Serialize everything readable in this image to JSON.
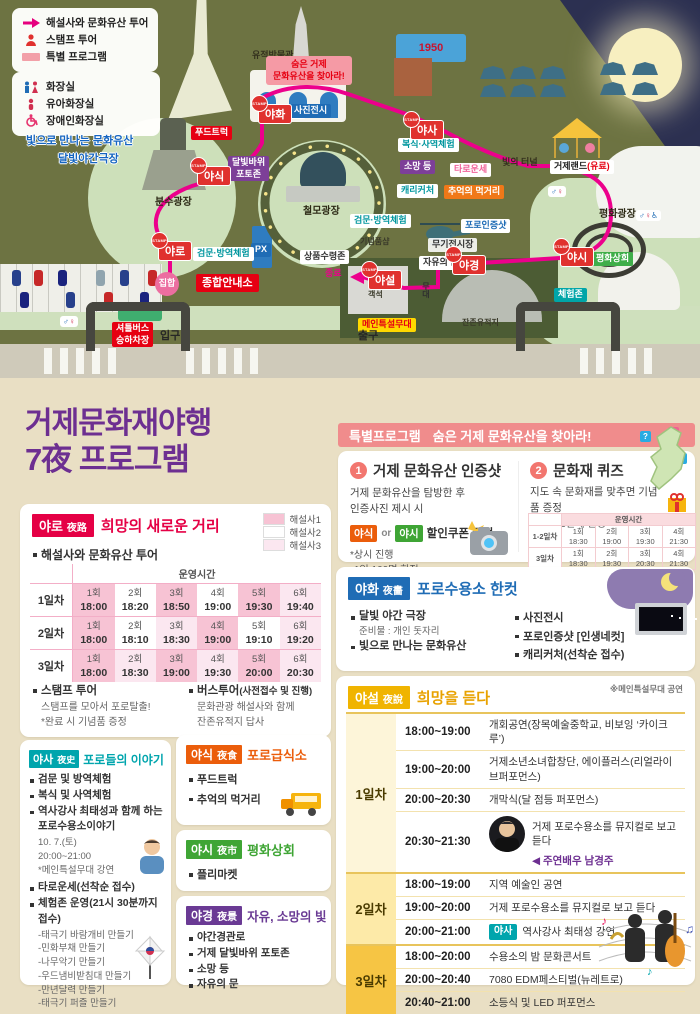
{
  "map": {
    "stamp_word": "STAMP",
    "banner": "숨은 거제\n문화유산을 찾아라!",
    "b1950": "1950",
    "legend_tour": [
      {
        "icon": "arrow-icon",
        "label": "해설사와 문화유산 투어"
      },
      {
        "icon": "person-icon",
        "label": "스탬프 투어"
      },
      {
        "icon": "bar-icon",
        "label": "특별 프로그램"
      }
    ],
    "legend_facility": [
      {
        "icon": "toilet-icon",
        "label": "화장실"
      },
      {
        "icon": "baby-icon",
        "label": "유아화장실"
      },
      {
        "icon": "wheelchair-icon",
        "label": "장애인화장실"
      }
    ],
    "labels": [
      {
        "t": "유적박물관",
        "x": 252,
        "y": 50,
        "v": "plain"
      },
      {
        "t": "숨은 거제\n문화유산을 찾아라!",
        "x": 266,
        "y": 56,
        "v": "banner"
      },
      {
        "t": "사진전시",
        "x": 290,
        "y": 104,
        "v": "blue"
      },
      {
        "t": "빛으로 만나는 문화유산",
        "x": 26,
        "y": 134,
        "v": "outblue"
      },
      {
        "t": "달빛야간극장",
        "x": 58,
        "y": 152,
        "v": "outblue"
      },
      {
        "t": "푸드트럭",
        "x": 191,
        "y": 126,
        "v": "red"
      },
      {
        "t": "달빛바위\n포토존",
        "x": 228,
        "y": 156,
        "v": "purple"
      },
      {
        "t": "분수광장",
        "x": 155,
        "y": 196,
        "v": "plainb"
      },
      {
        "t": "철모광장",
        "x": 303,
        "y": 205,
        "v": "plainb"
      },
      {
        "t": "복식·사역체험",
        "x": 398,
        "y": 138,
        "v": "tealtext"
      },
      {
        "t": "소망 등",
        "x": 400,
        "y": 160,
        "v": "purple"
      },
      {
        "t": "타로운세",
        "x": 450,
        "y": 163,
        "v": "pinktext"
      },
      {
        "t": "캐리커처",
        "x": 397,
        "y": 184,
        "v": "tealtext"
      },
      {
        "t": "추억의 먹거리",
        "x": 444,
        "y": 185,
        "v": "orange"
      },
      {
        "t": "빛의 터널",
        "x": 502,
        "y": 157,
        "v": "plain"
      },
      {
        "t": "거제랜드",
        "t2": "(유료)",
        "x": 550,
        "y": 160,
        "v": "white2"
      },
      {
        "t": "평화광장",
        "x": 599,
        "y": 208,
        "v": "plainb"
      },
      {
        "t": "검문·방역체험",
        "x": 350,
        "y": 214,
        "v": "tealtext"
      },
      {
        "t": "기념품샵",
        "x": 360,
        "y": 237,
        "v": "tiny"
      },
      {
        "t": "무기전시장",
        "x": 428,
        "y": 238,
        "v": "whiteplain"
      },
      {
        "t": "포로인증샷",
        "x": 461,
        "y": 219,
        "v": "bluetext"
      },
      {
        "t": "자유의 문",
        "x": 419,
        "y": 256,
        "v": "whiteb"
      },
      {
        "t": "PX",
        "x": 251,
        "y": 243,
        "v": "blue"
      },
      {
        "t": "검문·방역체험",
        "x": 193,
        "y": 247,
        "v": "tealtext"
      },
      {
        "t": "상품수령존",
        "x": 300,
        "y": 250,
        "v": "whiteb"
      },
      {
        "t": "종합안내소",
        "x": 196,
        "y": 274,
        "v": "redb"
      },
      {
        "t": "집합",
        "x": 155,
        "y": 272,
        "v": "pinkcircle"
      },
      {
        "t": "종료",
        "x": 325,
        "y": 268,
        "v": "pinkplain"
      },
      {
        "t": "객석",
        "x": 368,
        "y": 290,
        "v": "tiny"
      },
      {
        "t": "무대",
        "x": 420,
        "y": 282,
        "v": "tinyv"
      },
      {
        "t": "메인특설무대",
        "x": 358,
        "y": 318,
        "v": "yellow"
      },
      {
        "t": "잔존유적지",
        "x": 462,
        "y": 318,
        "v": "tiny"
      },
      {
        "t": "평화상회",
        "x": 592,
        "y": 252,
        "v": "green"
      },
      {
        "t": "체험존",
        "x": 554,
        "y": 288,
        "v": "teal"
      },
      {
        "t": "입구",
        "x": 160,
        "y": 329,
        "v": "gate"
      },
      {
        "t": "출구",
        "x": 358,
        "y": 329,
        "v": "gate"
      },
      {
        "t": "셔틀버스\n승하차장",
        "x": 112,
        "y": 322,
        "v": "red"
      }
    ],
    "stamps": [
      {
        "t": "야화",
        "x": 258,
        "y": 104
      },
      {
        "t": "야사",
        "x": 410,
        "y": 120
      },
      {
        "t": "야식",
        "x": 197,
        "y": 166
      },
      {
        "t": "야로",
        "x": 158,
        "y": 241
      },
      {
        "t": "야경",
        "x": 452,
        "y": 255
      },
      {
        "t": "야시",
        "x": 560,
        "y": 247
      },
      {
        "t": "야설",
        "x": 368,
        "y": 270
      }
    ]
  },
  "title": {
    "line1": "거제문화재야행",
    "line2": "7夜 프로그램"
  },
  "special": {
    "header_label": "특별프로그램",
    "header_title": "숨은 거제 문화유산을 찾아라!",
    "item1": {
      "num": "1",
      "title": "거제 문화유산 인증샷",
      "desc1": "거제 문화유산을 탐방한 후",
      "desc2": "인증사진 제시 시",
      "badge1": "야식",
      "or": "or",
      "badge2": "야시",
      "coupon": "할인쿠폰 증정",
      "note1": "*상시 진행",
      "note2": "1일 100명 한정"
    },
    "item2": {
      "num": "2",
      "title": "문화재 퀴즈",
      "desc": "지도 속 문화재를 맞추면 기념품 증정",
      "note": "*회당 10문제 한정",
      "markers": [
        "?",
        "?",
        "?"
      ],
      "table": {
        "time_header": "운영시간",
        "rows": [
          {
            "day": "1-2일차",
            "cells": [
              {
                "label": "1회",
                "time": "18:30"
              },
              {
                "label": "2회",
                "time": "19:00"
              },
              {
                "label": "3회",
                "time": "19:30"
              },
              {
                "label": "4회",
                "time": "21:30"
              }
            ]
          },
          {
            "day": "3일차",
            "cells": [
              {
                "label": "1회",
                "time": "18:30"
              },
              {
                "label": "2회",
                "time": "19:30"
              },
              {
                "label": "3회",
                "time": "20:30"
              },
              {
                "label": "4회",
                "time": "21:30"
              }
            ]
          }
        ]
      }
    }
  },
  "yaro": {
    "badge": "야로",
    "hanja": "夜路",
    "title": "희망의 새로운 거리",
    "legend": [
      "해설사1",
      "해설사2",
      "해설사3"
    ],
    "bullet": "해설사와 문화유산 투어",
    "table": {
      "time_header": "운영시간",
      "rows": [
        {
          "day": "1일차",
          "cells": [
            {
              "label": "1회",
              "time": "18:00",
              "c": "p"
            },
            {
              "label": "2회",
              "time": "18:20",
              "c": "w"
            },
            {
              "label": "3회",
              "time": "18:50",
              "c": "p"
            },
            {
              "label": "4회",
              "time": "19:00",
              "c": "w"
            },
            {
              "label": "5회",
              "time": "19:30",
              "c": "p"
            },
            {
              "label": "6회",
              "time": "19:40",
              "c": "l"
            }
          ]
        },
        {
          "day": "2일차",
          "cells": [
            {
              "label": "1회",
              "time": "18:00",
              "c": "p"
            },
            {
              "label": "2회",
              "time": "18:10",
              "c": "w"
            },
            {
              "label": "3회",
              "time": "18:30",
              "c": "l"
            },
            {
              "label": "4회",
              "time": "19:00",
              "c": "p"
            },
            {
              "label": "5회",
              "time": "19:10",
              "c": "w"
            },
            {
              "label": "6회",
              "time": "19:20",
              "c": "l"
            }
          ]
        },
        {
          "day": "3일차",
          "cells": [
            {
              "label": "1회",
              "time": "18:00",
              "c": "p"
            },
            {
              "label": "2회",
              "time": "18:30",
              "c": "l"
            },
            {
              "label": "3회",
              "time": "19:00",
              "c": "p"
            },
            {
              "label": "4회",
              "time": "19:30",
              "c": "l"
            },
            {
              "label": "5회",
              "time": "20:00",
              "c": "p"
            },
            {
              "label": "6회",
              "time": "20:30",
              "c": "l"
            }
          ]
        }
      ]
    },
    "notes": {
      "stamp_title": "스탬프 투어",
      "stamp_l1": "스탬프를 모아서 포로탈출!",
      "stamp_l2": "*완료 시 기념품 증정",
      "bus_title": "버스투어",
      "bus_paren": "(사전접수 및 진행)",
      "bus_l1": "문화관광 해설사와 함께",
      "bus_l2": "잔존유적지 답사"
    }
  },
  "yahwa": {
    "badge": "야화",
    "hanja": "夜畵",
    "title": "포로수용소 한컷",
    "col1": [
      {
        "text": "달빛 야간 극장",
        "sub": "준비물 : 개인 돗자리"
      },
      {
        "text": "빛으로 만나는 문화유산"
      }
    ],
    "col2": [
      {
        "text": "사진전시"
      },
      {
        "text": "포로인증샷 [인생네컷]"
      },
      {
        "text": "캐리커처(선착순 접수)"
      }
    ]
  },
  "yaseol": {
    "badge": "야설",
    "hanja": "夜說",
    "title": "희망을 듣다",
    "note": "※메인특설무대 공연",
    "days": [
      {
        "day": "1일차",
        "tone": "d1",
        "rows": [
          {
            "time": "18:00~19:00",
            "program": "개회공연(장목예술중학교, 비보잉 ‘카이크루’)"
          },
          {
            "time": "19:00~20:00",
            "program": "거제소년소녀합창단, 에이플러스(리얼라이브퍼포먼스)"
          },
          {
            "time": "20:00~20:30",
            "program": "개막식(달 점등 퍼포먼스)"
          },
          {
            "time": "20:30~21:30",
            "program": "거제 포로수용소를 뮤지컬로 보고 듣다",
            "extra": "◀ 주연배우 남경주",
            "photo": true
          }
        ]
      },
      {
        "day": "2일차",
        "tone": "d2",
        "rows": [
          {
            "time": "18:00~19:00",
            "program": "지역 예술인 공연"
          },
          {
            "time": "19:00~20:00",
            "program": "거제 포로수용소를 뮤지컬로 보고 듣다"
          },
          {
            "time": "20:00~21:00",
            "program": "역사강사 최태성 강연",
            "badge": "야사"
          }
        ]
      },
      {
        "day": "3일차",
        "tone": "d3",
        "rows": [
          {
            "time": "18:00~20:00",
            "program": "수용소의 밤 문화콘서트"
          },
          {
            "time": "20:00~20:40",
            "program": "7080 EDM페스티벌(뉴레트로)"
          },
          {
            "time": "20:40~21:00",
            "program": "소등식 및 LED 퍼포먼스"
          }
        ]
      }
    ]
  },
  "yasa": {
    "badge": "야사",
    "hanja": "夜史",
    "title": "포로들의 이야기",
    "items": [
      {
        "text": "검문 및 방역체험"
      },
      {
        "text": "복식 및 사역체험"
      },
      {
        "text": "역사강사 최태성과 함께 하는 포로수용소이야기",
        "subs": [
          "10. 7.(토)",
          "20:00~21:00",
          "*메인특설무대 강연"
        ],
        "photo": true
      },
      {
        "text": "타로운세(선착순 접수)"
      },
      {
        "text": "체험존 운영(21시 30분까지 접수)",
        "subs": [
          "-태극기 바람개비 만들기",
          "-민화부채 만들기",
          "-나무악기 만들기",
          "-우드냄비받침대 만들기",
          "-만년달력 만들기",
          "-태극기 퍼즐 만들기"
        ]
      }
    ]
  },
  "yasik": {
    "badge": "야식",
    "hanja": "夜食",
    "title": "포로급식소",
    "items": [
      "푸드트럭",
      "추억의 먹거리"
    ]
  },
  "yasi": {
    "badge": "야시",
    "hanja": "夜市",
    "title": "평화상회",
    "items": [
      "플리마켓"
    ]
  },
  "yagyeong": {
    "badge": "야경",
    "hanja": "夜景",
    "title": "자유, 소망의 빛",
    "items": [
      "야간경관로",
      "거제 달빛바위 포토존",
      "소망 등",
      "자유의 문"
    ]
  }
}
